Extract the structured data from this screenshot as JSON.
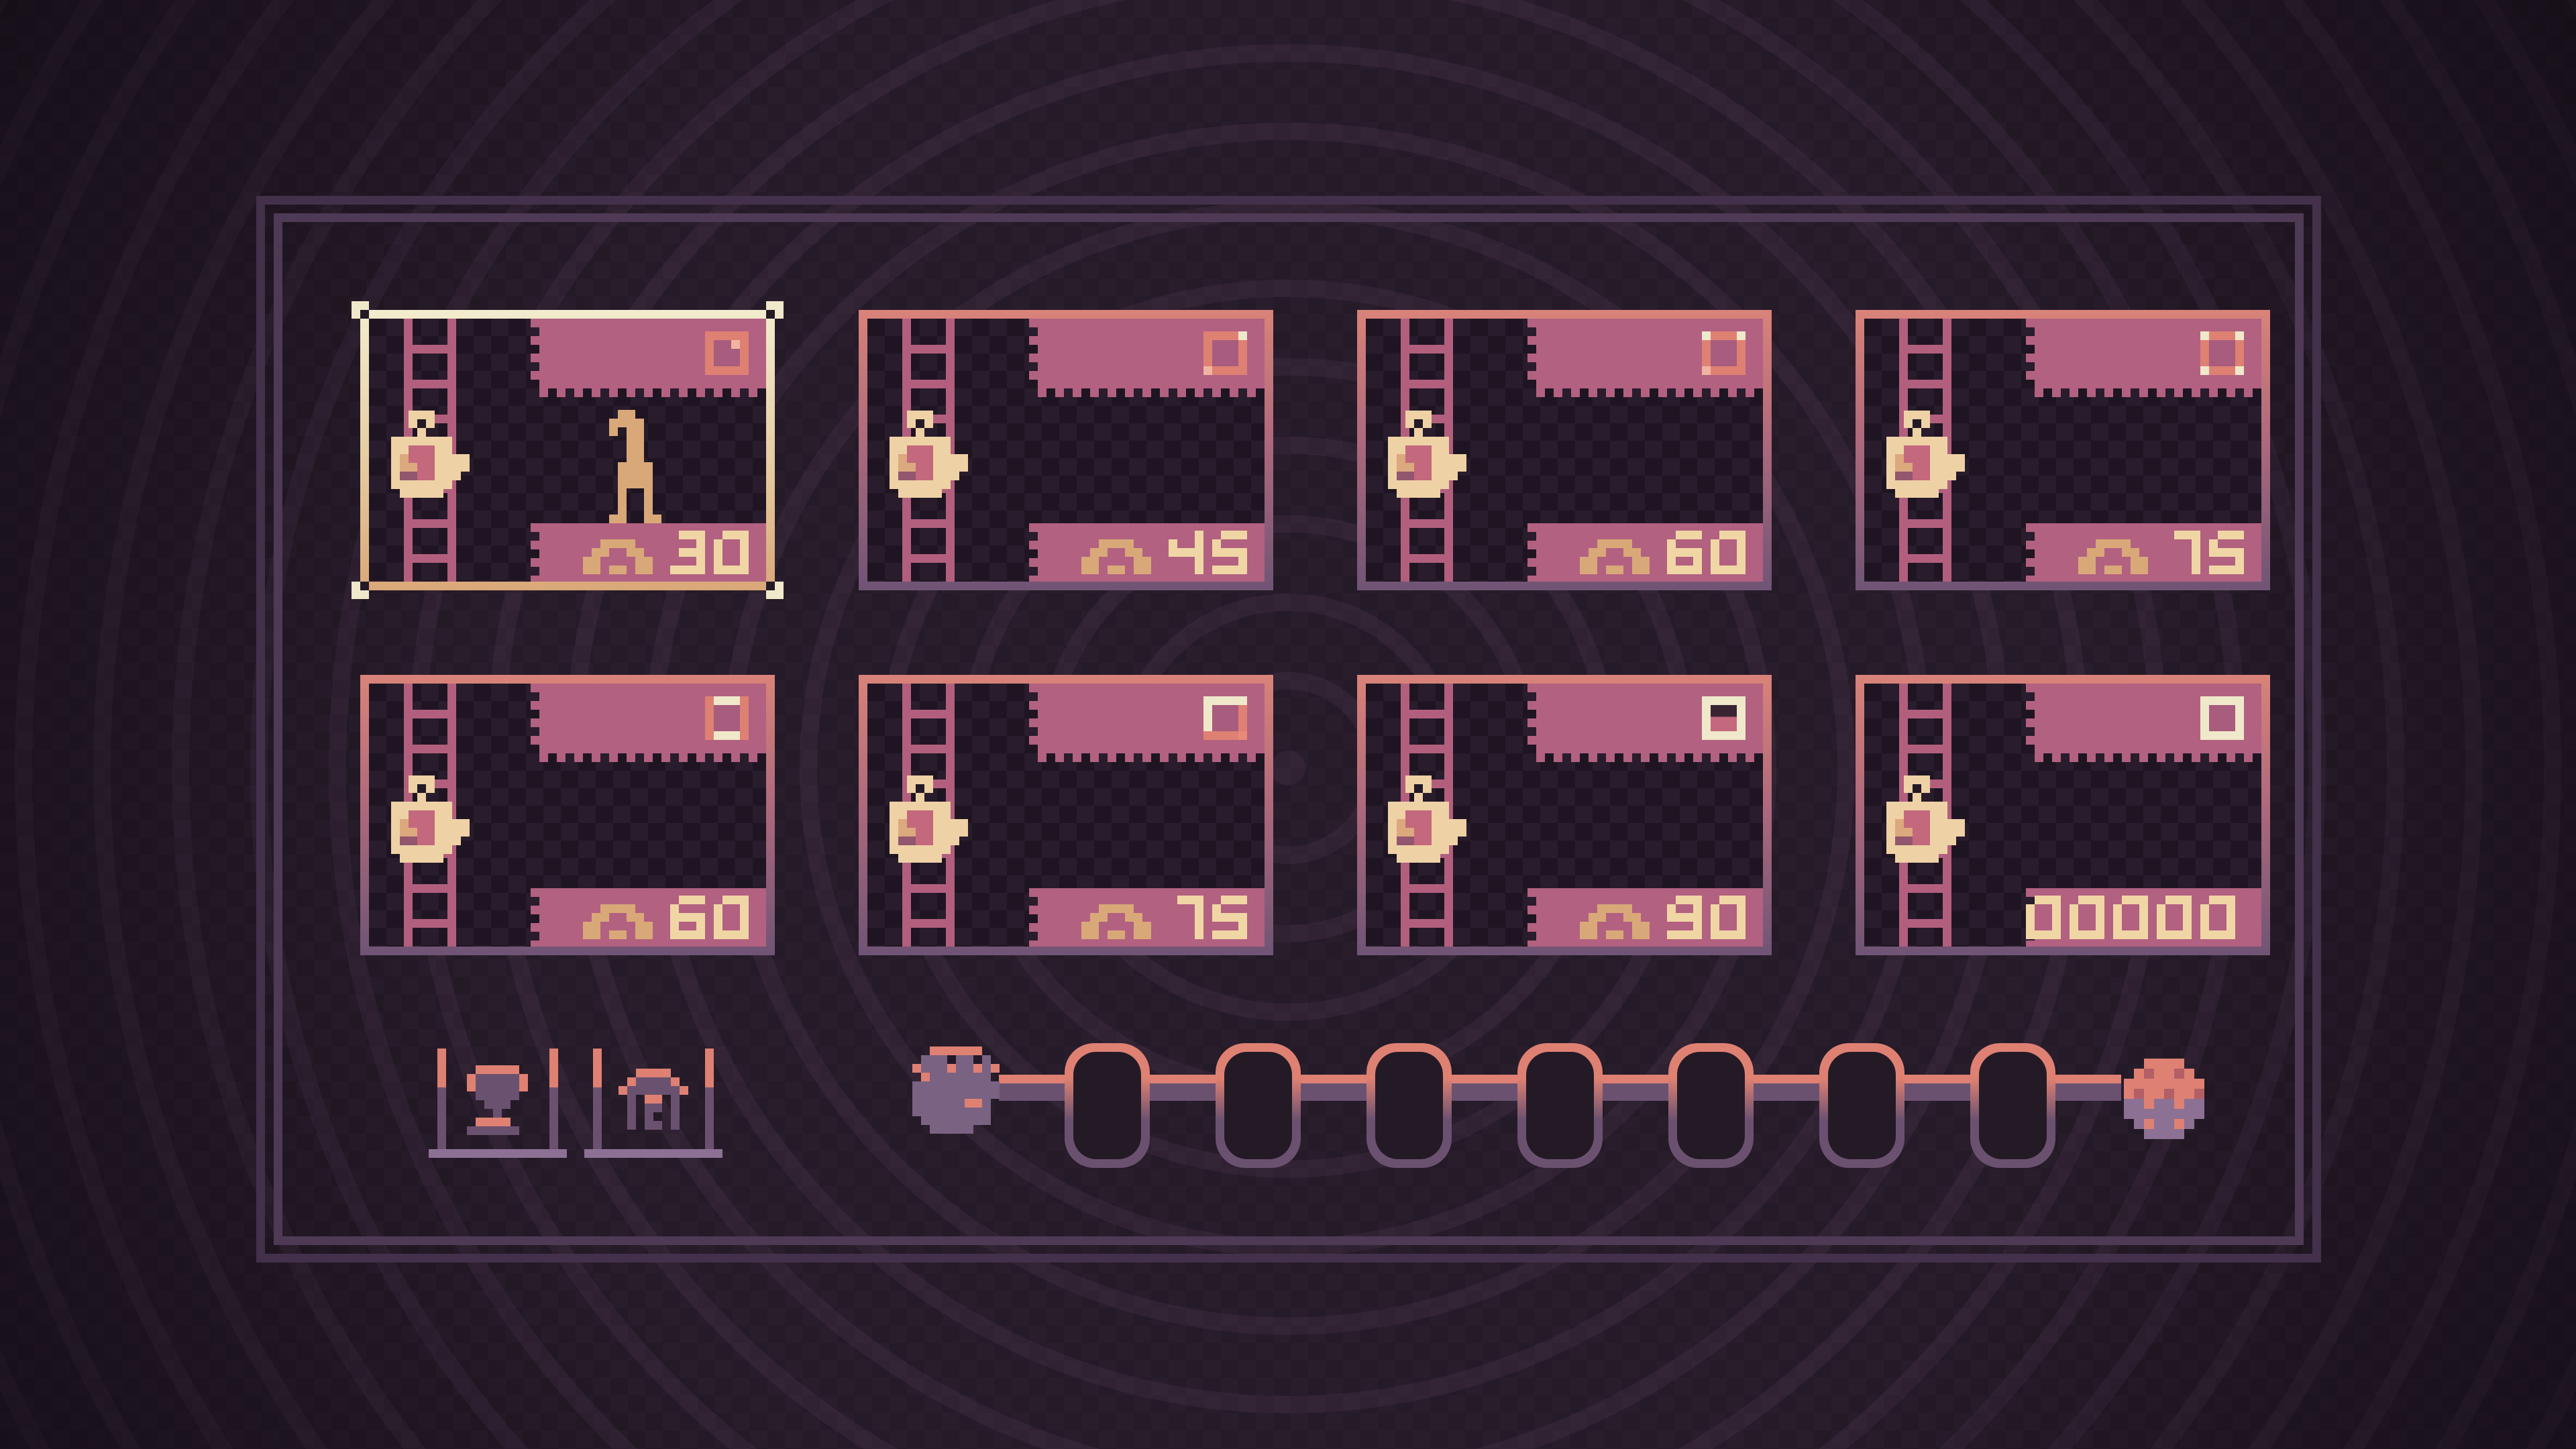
{
  "screen": {
    "type": "level-select"
  },
  "colors": {
    "background": "#251a27",
    "frame_line": "#4e3a55",
    "card_border_top": "#d98379",
    "card_border_bottom": "#6f5475",
    "card_background": "#1f1522",
    "banner_pink": "#b26181",
    "banner_pink_deep": "#a85c7e",
    "salmon_accent": "#de8173",
    "selected_border_cream": "#f0e8ca",
    "tan": "#d9a878",
    "number_text": "#f0d6a5",
    "ladder": "#b25f7e",
    "icon_purple": "#6b5170",
    "light_purple": "#8d7194"
  },
  "cards": [
    {
      "position": 1,
      "selected": true,
      "value": "30",
      "has_arch_icon": true,
      "flag_stage": 1,
      "flag_state": "stamp-blank",
      "has_character_sprite": true
    },
    {
      "position": 2,
      "selected": false,
      "value": "45",
      "has_arch_icon": true,
      "flag_stage": 2,
      "flag_state": "stamp-corner"
    },
    {
      "position": 3,
      "selected": false,
      "value": "60",
      "has_arch_icon": true,
      "flag_stage": 3,
      "flag_state": "stamp-corners-2"
    },
    {
      "position": 4,
      "selected": false,
      "value": "75",
      "has_arch_icon": true,
      "flag_stage": 4,
      "flag_state": "stamp-corners-4"
    },
    {
      "position": 5,
      "selected": false,
      "value": "60",
      "has_arch_icon": true,
      "flag_stage": 5,
      "flag_state": "stamp-edges-top-bottom"
    },
    {
      "position": 6,
      "selected": false,
      "value": "75",
      "has_arch_icon": true,
      "flag_stage": 6,
      "flag_state": "stamp-edges-top-left"
    },
    {
      "position": 7,
      "selected": false,
      "value": "90",
      "has_arch_icon": true,
      "flag_stage": 7,
      "flag_state": "stamp-nearly-complete"
    },
    {
      "position": 8,
      "selected": false,
      "value": "00000",
      "has_arch_icon": false,
      "flag_stage": 8,
      "flag_state": "stamp-complete",
      "score_card": true
    }
  ],
  "toolbar": {
    "buttons": [
      {
        "id": "trophy-button",
        "icon": "trophy-icon"
      },
      {
        "id": "home-button",
        "icon": "home-icon"
      }
    ]
  },
  "progress_chain": {
    "slot_count": 9,
    "slots": [
      {
        "index": 1,
        "state": "occupied",
        "sprite": "blob-face"
      },
      {
        "index": 2,
        "state": "empty"
      },
      {
        "index": 3,
        "state": "empty"
      },
      {
        "index": 4,
        "state": "empty"
      },
      {
        "index": 5,
        "state": "empty"
      },
      {
        "index": 6,
        "state": "empty"
      },
      {
        "index": 7,
        "state": "empty"
      },
      {
        "index": 8,
        "state": "empty"
      },
      {
        "index": 9,
        "state": "occupied",
        "sprite": "berry-ball"
      }
    ]
  }
}
